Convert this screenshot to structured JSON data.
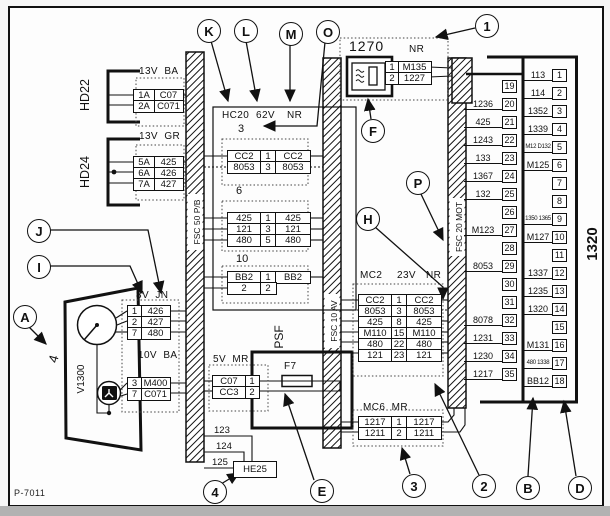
{
  "page": {
    "code": "P-7011"
  },
  "callouts": {
    "k": "K",
    "l": "L",
    "m": "M",
    "o": "O",
    "n1": "1",
    "f": "F",
    "p": "P",
    "h": "H",
    "j": "J",
    "i": "I",
    "a": "A",
    "n4": "4",
    "e": "E",
    "n3": "3",
    "n2": "2",
    "b": "B",
    "d": "D"
  },
  "bus_left": {
    "label": "FSC 50 P/B"
  },
  "bus_mid": {
    "label": "FSC 10 AV"
  },
  "bus_right": {
    "label": "FSC 20 MOT"
  },
  "hd22": {
    "title": "HD22",
    "header": "13V  BA",
    "rows": [
      [
        "1A",
        "C07"
      ],
      [
        "2A",
        "C071"
      ]
    ]
  },
  "hd24": {
    "title": "HD24",
    "header": "13V  GR",
    "rows": [
      [
        "5A",
        "425"
      ],
      [
        "6A",
        "426"
      ],
      [
        "7A",
        "427"
      ]
    ]
  },
  "block62": {
    "h1": "HC20",
    "h2": "62V",
    "h3": "NR",
    "sub3": {
      "label": "3",
      "rows": [
        [
          "CC2",
          "1",
          "CC2"
        ],
        [
          "8053",
          "3",
          "8053"
        ]
      ]
    },
    "sub6": {
      "label": "6",
      "rows": [
        [
          "425",
          "1",
          "425"
        ],
        [
          "121",
          "3",
          "121"
        ],
        [
          "480",
          "5",
          "480"
        ]
      ]
    },
    "sub10": {
      "label": "10",
      "rows": [
        [
          "BB2",
          "1",
          "BB2"
        ],
        [
          "2",
          "2",
          ""
        ]
      ]
    }
  },
  "unit1270": {
    "title": "1270",
    "header": "NR",
    "rows": [
      [
        "1",
        "M135"
      ],
      [
        "2",
        "1227"
      ]
    ]
  },
  "mc2": {
    "h1": "MC2",
    "h2": "23V",
    "h3": "NR",
    "rows": [
      [
        "CC2",
        "1",
        "CC2"
      ],
      [
        "8053",
        "3",
        "8053"
      ],
      [
        "425",
        "8",
        "425"
      ],
      [
        "M110",
        "15",
        "M110"
      ],
      [
        "480",
        "22",
        "480"
      ],
      [
        "121",
        "23",
        "121"
      ]
    ]
  },
  "mc6": {
    "header": "MC6  MR",
    "rows": [
      [
        "1217",
        "1",
        "1217"
      ],
      [
        "1211",
        "2",
        "1211"
      ]
    ]
  },
  "ecu": {
    "label": "1320",
    "inner": [
      {
        "w": "",
        "p": "19"
      },
      {
        "w": "1236",
        "p": "20"
      },
      {
        "w": "425",
        "p": "21"
      },
      {
        "w": "1243",
        "p": "22"
      },
      {
        "w": "133",
        "p": "23"
      },
      {
        "w": "1367",
        "p": "24"
      },
      {
        "w": "132",
        "p": "25"
      },
      {
        "w": "",
        "p": "26"
      },
      {
        "w": "M123",
        "p": "27"
      },
      {
        "w": "",
        "p": "28"
      },
      {
        "w": "8053",
        "p": "29"
      },
      {
        "w": "",
        "p": "30"
      },
      {
        "w": "",
        "p": "31"
      },
      {
        "w": "8078",
        "p": "32"
      },
      {
        "w": "1231",
        "p": "33"
      },
      {
        "w": "1230",
        "p": "34"
      },
      {
        "w": "1217",
        "p": "35"
      }
    ],
    "outer": [
      {
        "w": "113",
        "p": "1"
      },
      {
        "w": "114",
        "p": "2"
      },
      {
        "w": "1352",
        "p": "3"
      },
      {
        "w": "1339",
        "p": "4"
      },
      {
        "w": "M12 D132",
        "p": "5"
      },
      {
        "w": "M125",
        "p": "6"
      },
      {
        "w": "",
        "p": "7"
      },
      {
        "w": "",
        "p": "8"
      },
      {
        "w": "1350 1365",
        "p": "9"
      },
      {
        "w": "M127",
        "p": "10"
      },
      {
        "w": "",
        "p": "11"
      },
      {
        "w": "1337",
        "p": "12"
      },
      {
        "w": "1235",
        "p": "13"
      },
      {
        "w": "1320",
        "p": "14"
      },
      {
        "w": "",
        "p": "15"
      },
      {
        "w": "M131",
        "p": "16"
      },
      {
        "w": "480 1338",
        "p": "17"
      },
      {
        "w": "BB12",
        "p": "18"
      }
    ]
  },
  "blockA": {
    "num": "4",
    "device": "V1300",
    "header1": "8V  JN",
    "rows1": [
      [
        "1",
        "426"
      ],
      [
        "2",
        "427"
      ],
      [
        "7",
        "480"
      ]
    ],
    "header2": "10V  BA",
    "rows2": [
      [
        "3",
        "M400"
      ],
      [
        "7",
        "C071"
      ]
    ]
  },
  "psf": {
    "label": "PSF",
    "fuse": "F7",
    "header": "5V  MR",
    "rows": [
      [
        "C07",
        "1"
      ],
      [
        "CC3",
        "2"
      ]
    ]
  },
  "he25": {
    "label": "HE25",
    "wires": [
      "123",
      "124",
      "125"
    ]
  }
}
